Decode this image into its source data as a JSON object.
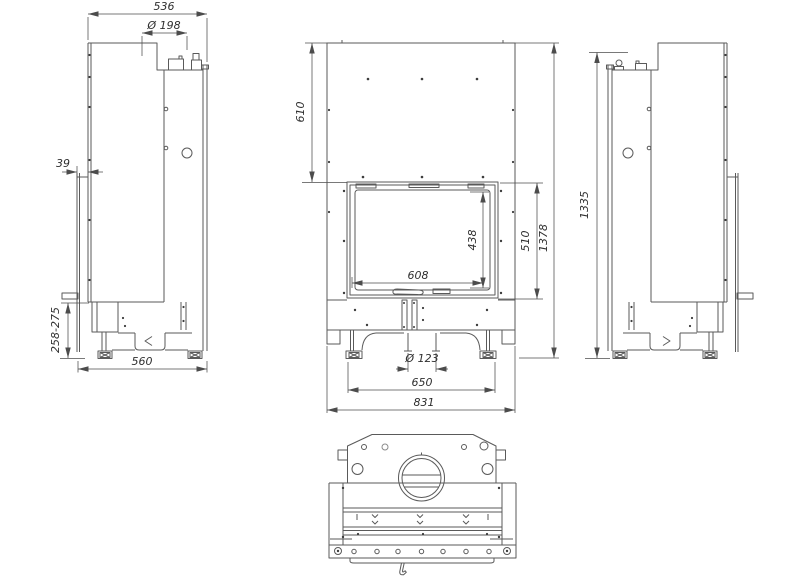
{
  "colors": {
    "background": "#ffffff",
    "line": "#5a5a5a",
    "dimension_line": "#4c4c4c",
    "text": "#2f2f2f"
  },
  "dimensions": {
    "left_view": {
      "overall_depth": "536",
      "flue_diameter": "Ø 198",
      "rear_shield_offset": "39",
      "base_height_range": "258-275",
      "bottom_depth": "560"
    },
    "front_view": {
      "top_to_door": "610",
      "glass_height": "438",
      "door_height": "510",
      "overall_height": "1378",
      "glass_width": "608",
      "air_inlet_diameter": "Ø 123",
      "feet_spacing": "650",
      "overall_width": "831"
    },
    "right_view": {
      "body_height": "1335"
    }
  }
}
